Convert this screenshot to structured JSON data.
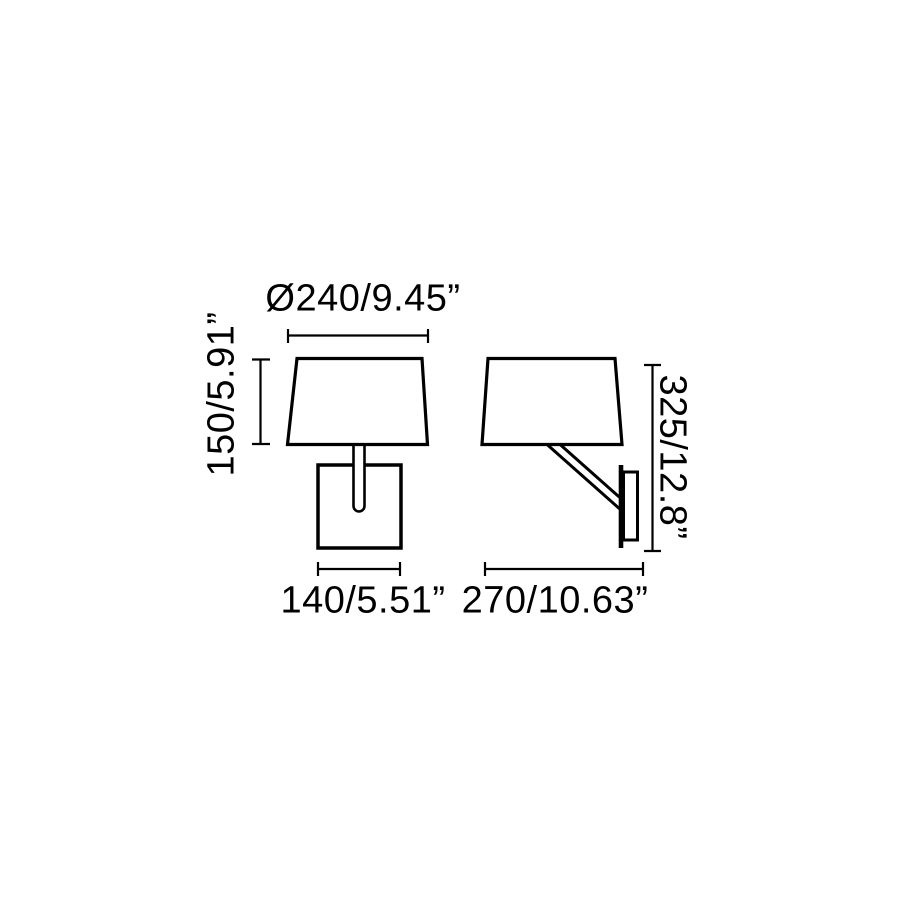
{
  "figure": {
    "kind": "wall-lamp-technical-dimension-drawing",
    "views": [
      "front",
      "side"
    ]
  },
  "dims": {
    "diameter": "Ø240/9.45”",
    "shade_height": "150/5.91”",
    "base_width": "140/5.51”",
    "total_height": "325/12.8”",
    "projection": "270/10.63”"
  },
  "colors": {
    "line": "#000000",
    "background": "#ffffff"
  }
}
